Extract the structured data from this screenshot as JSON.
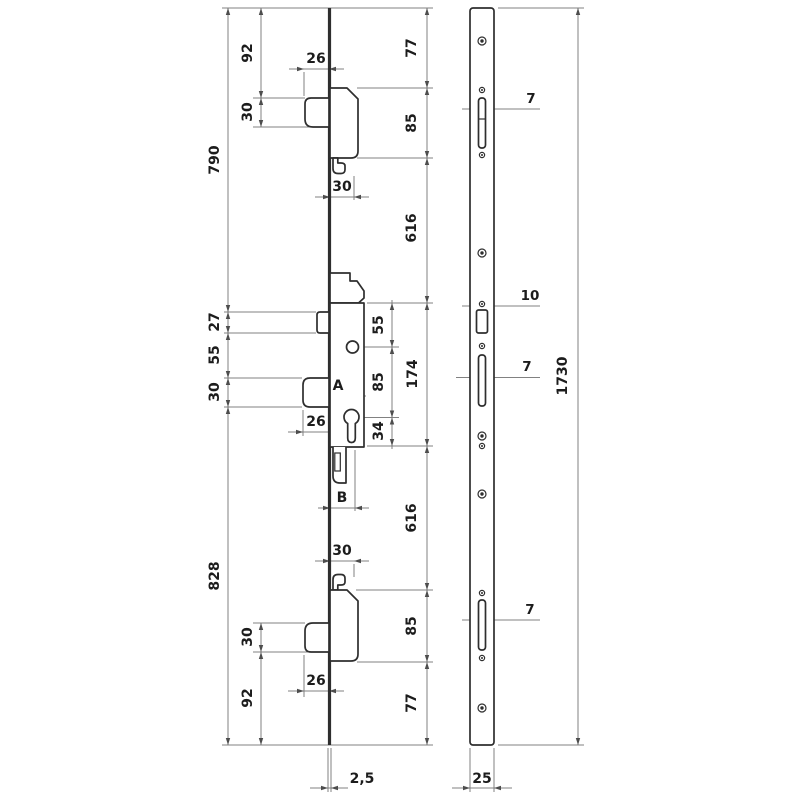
{
  "drawing": {
    "title": "Multipoint mortise lock technical drawing",
    "left_view": "lock side elevation",
    "right_view": "faceplate front view"
  },
  "dims": {
    "overall_top": "790",
    "overall_bottom": "828",
    "top_edge_offset": "92",
    "top_bolt_height": "30",
    "top_bolt_protrusion": "26",
    "top_hook_depth": "30",
    "latch_height": "27",
    "latch_to_deadbolt": "55",
    "deadbolt_height": "30",
    "deadbolt_protrusion": "26",
    "backset_a": "A",
    "backset_b": "B",
    "spindle_offset": "55",
    "spindle_to_cylinder": "85",
    "cylinder_to_case": "34",
    "case_span": "174",
    "plate_end_top": "77",
    "hook_case_top": "85",
    "hook_to_center_top": "616",
    "hook_to_center_bottom": "616",
    "hook_case_bottom": "85",
    "plate_end_bottom": "77",
    "bottom_hook_depth": "30",
    "bottom_bolt_height": "30",
    "bottom_bolt_protrusion": "26",
    "bottom_edge_offset": "92",
    "plate_thickness": "2,5",
    "faceplate_width": "25",
    "faceplate_length": "1730",
    "slot_width_top": "7",
    "latch_slot_width": "10",
    "slot_width_mid": "7",
    "slot_width_bottom": "7"
  }
}
